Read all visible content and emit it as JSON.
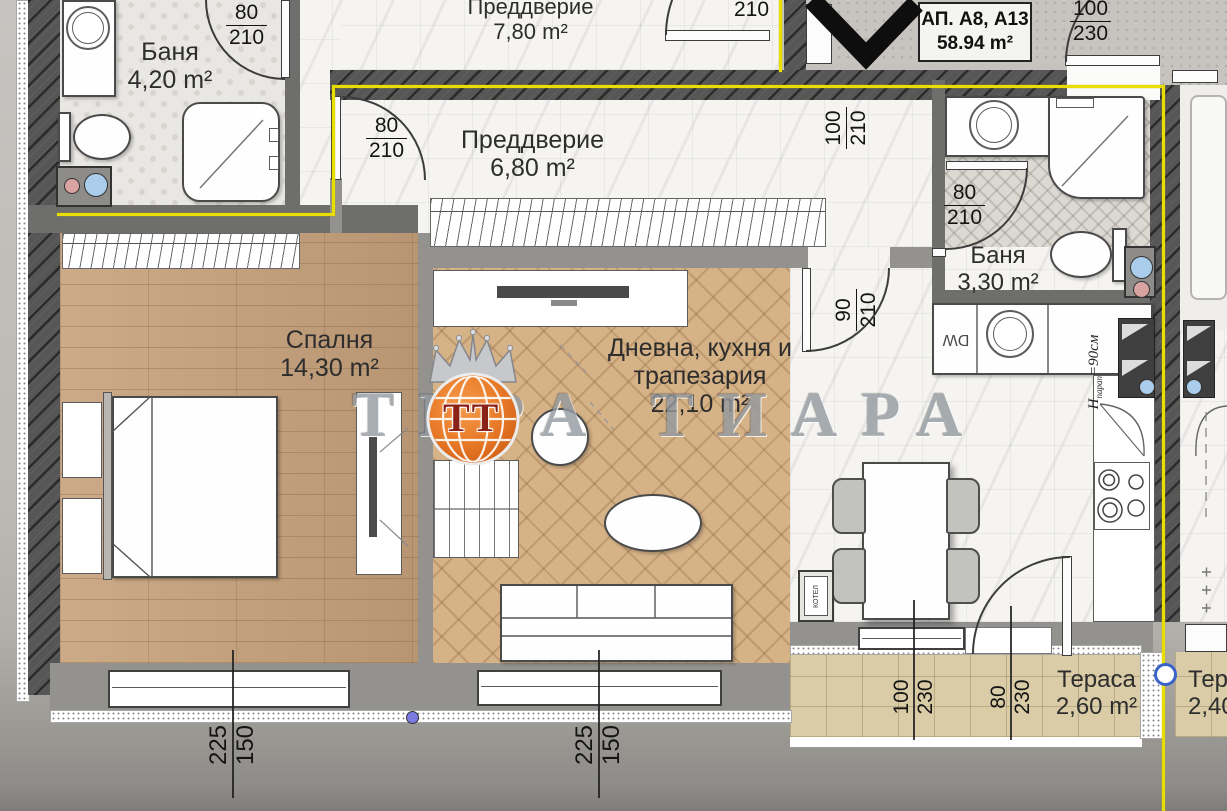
{
  "watermark": {
    "brand": "ТЕРА ТИАРА",
    "logo_initials": "ТТ"
  },
  "apartment": {
    "id": "АП. А8, А13",
    "area": "58.94 m²"
  },
  "rooms": {
    "bath1": {
      "name": "Баня",
      "area": "4,20 m²"
    },
    "hall_upper": {
      "name": "Преддверие",
      "area": "7,80 m²"
    },
    "hall": {
      "name": "Преддверие",
      "area": "6,80 m²"
    },
    "bath2": {
      "name": "Баня",
      "area": "3,30 m²"
    },
    "bedroom": {
      "name": "Спалня",
      "area": "14,30 m²"
    },
    "living": {
      "line1": "Дневна, кухня и",
      "line2": "трапезария",
      "area": "22,10 m²"
    },
    "terrace1": {
      "name": "Тераса",
      "area": "2,60 m²"
    },
    "terrace2": {
      "name": "Тераса",
      "area": "2,40 m²"
    }
  },
  "dimensions": {
    "bath1_door": {
      "a": "80",
      "b": "210"
    },
    "hall_upper_door": {
      "b": "210"
    },
    "entry_door": {
      "a": "100",
      "b": "230"
    },
    "entry_side": {
      "a": "100",
      "b": "210"
    },
    "bedroom_door": {
      "a": "80",
      "b": "210"
    },
    "bath2_door": {
      "a": "80",
      "b": "210"
    },
    "kitchen_door": {
      "a": "90",
      "b": "210"
    },
    "bedroom_window": {
      "a": "225",
      "b": "150"
    },
    "living_window": {
      "a": "225",
      "b": "150"
    },
    "terrace_door": {
      "a": "100",
      "b": "230"
    },
    "terrace_window": {
      "a": "80",
      "b": "230"
    }
  },
  "annotations": {
    "dishwasher": "DW",
    "boiler": "КОТЕЛ",
    "parapet_h": "H",
    "parapet_sub": "парап",
    "parapet_val": "=90см"
  }
}
